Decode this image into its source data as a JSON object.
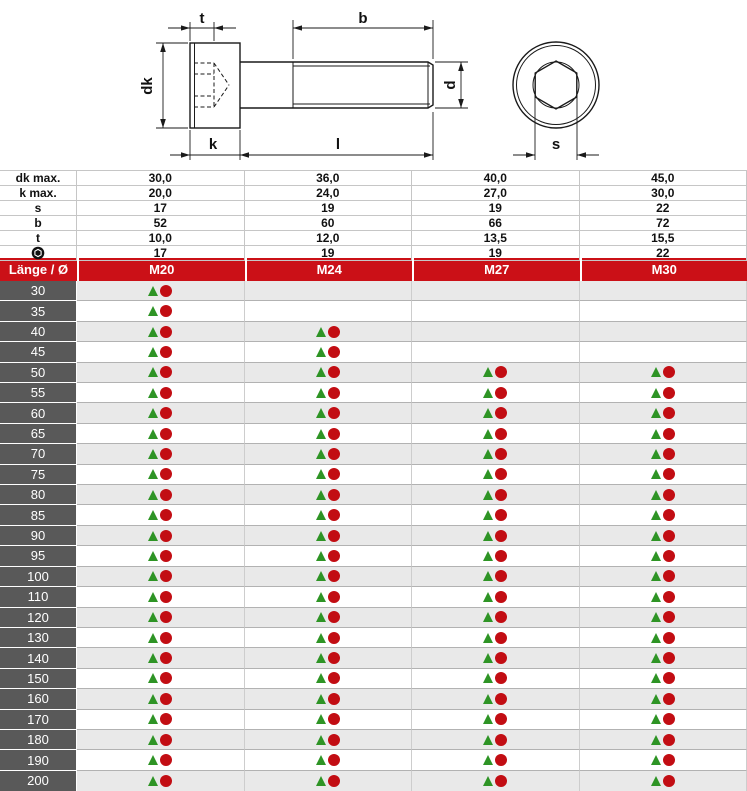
{
  "drawing": {
    "name": "socket-head-cap-screw-technical-drawing",
    "labels": {
      "t": "t",
      "b": "b",
      "dk": "dk",
      "d": "d",
      "k": "k",
      "l": "l",
      "s": "s"
    }
  },
  "spec_table": {
    "rows": [
      {
        "label": "dk max.",
        "values": [
          "30,0",
          "36,0",
          "40,0",
          "45,0"
        ]
      },
      {
        "label": "k max.",
        "values": [
          "20,0",
          "24,0",
          "27,0",
          "30,0"
        ]
      },
      {
        "label": "s",
        "values": [
          "17",
          "19",
          "19",
          "22"
        ]
      },
      {
        "label": "b",
        "values": [
          "52",
          "60",
          "66",
          "72"
        ]
      },
      {
        "label": "t",
        "values": [
          "10,0",
          "12,0",
          "13,5",
          "15,5"
        ]
      },
      {
        "label": "",
        "icon": "socket-symbol",
        "values": [
          "17",
          "19",
          "19",
          "22"
        ]
      }
    ]
  },
  "size_table": {
    "header": {
      "label": "Länge / Ø",
      "columns": [
        "M20",
        "M24",
        "M27",
        "M30"
      ]
    },
    "rows": [
      {
        "length": "30",
        "available": [
          true,
          false,
          false,
          false
        ]
      },
      {
        "length": "35",
        "available": [
          true,
          false,
          false,
          false
        ]
      },
      {
        "length": "40",
        "available": [
          true,
          true,
          false,
          false
        ]
      },
      {
        "length": "45",
        "available": [
          true,
          true,
          false,
          false
        ]
      },
      {
        "length": "50",
        "available": [
          true,
          true,
          true,
          true
        ]
      },
      {
        "length": "55",
        "available": [
          true,
          true,
          true,
          true
        ]
      },
      {
        "length": "60",
        "available": [
          true,
          true,
          true,
          true
        ]
      },
      {
        "length": "65",
        "available": [
          true,
          true,
          true,
          true
        ]
      },
      {
        "length": "70",
        "available": [
          true,
          true,
          true,
          true
        ]
      },
      {
        "length": "75",
        "available": [
          true,
          true,
          true,
          true
        ]
      },
      {
        "length": "80",
        "available": [
          true,
          true,
          true,
          true
        ]
      },
      {
        "length": "85",
        "available": [
          true,
          true,
          true,
          true
        ]
      },
      {
        "length": "90",
        "available": [
          true,
          true,
          true,
          true
        ]
      },
      {
        "length": "95",
        "available": [
          true,
          true,
          true,
          true
        ]
      },
      {
        "length": "100",
        "available": [
          true,
          true,
          true,
          true
        ]
      },
      {
        "length": "110",
        "available": [
          true,
          true,
          true,
          true
        ]
      },
      {
        "length": "120",
        "available": [
          true,
          true,
          true,
          true
        ]
      },
      {
        "length": "130",
        "available": [
          true,
          true,
          true,
          true
        ]
      },
      {
        "length": "140",
        "available": [
          true,
          true,
          true,
          true
        ]
      },
      {
        "length": "150",
        "available": [
          true,
          true,
          true,
          true
        ]
      },
      {
        "length": "160",
        "available": [
          true,
          true,
          true,
          true
        ]
      },
      {
        "length": "170",
        "available": [
          true,
          true,
          true,
          true
        ]
      },
      {
        "length": "180",
        "available": [
          true,
          true,
          true,
          true
        ]
      },
      {
        "length": "190",
        "available": [
          true,
          true,
          true,
          true
        ]
      },
      {
        "length": "200",
        "available": [
          true,
          true,
          true,
          true
        ]
      }
    ]
  },
  "colors": {
    "header_red": "#cb1017",
    "label_gray": "#595959",
    "row_alt": "#e9e9e9",
    "triangle_green": "#2e9425",
    "circle_red": "#c20d13"
  }
}
